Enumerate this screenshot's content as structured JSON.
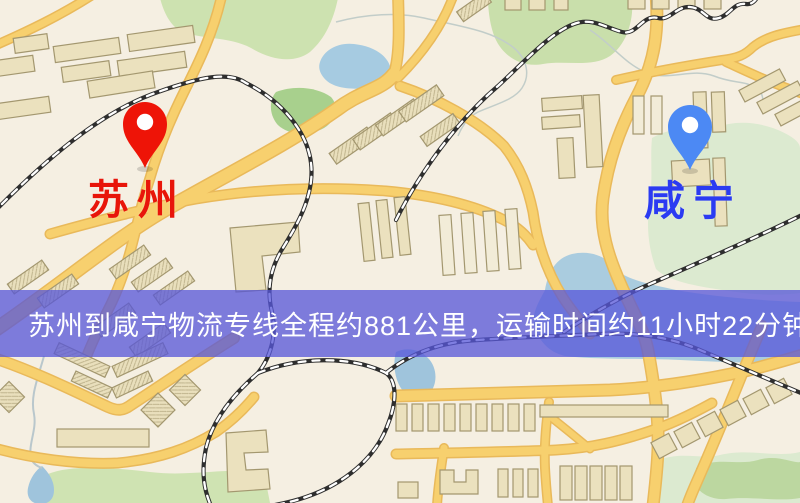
{
  "markers": {
    "origin": {
      "label": "苏州",
      "color": "#e8150a",
      "pin": "red-pin"
    },
    "destination": {
      "label": "咸宁",
      "color": "#2b3bf2",
      "pin": "blue-pin"
    }
  },
  "banner": {
    "text": "苏州到咸宁物流专线全程约881公里，运输时间约11小时22分钟.",
    "background": "#5757d9",
    "text_color": "#ffffff"
  },
  "route": {
    "origin": "苏州",
    "destination": "咸宁",
    "distance_km": "881",
    "duration": "11小时22分钟"
  },
  "palette": {
    "map_background": "#f5efe2",
    "road_fill": "#f7d06e",
    "road_casing": "#e9b95a",
    "water": "#a6cbe1",
    "park": "#cde2b0",
    "park_dark": "#a8d08d",
    "building_fill": "#ebe1be",
    "building_stroke": "#a3976f",
    "railway": "#2e2e2e",
    "pin_red": "#ee1407",
    "pin_blue": "#4c89f4"
  }
}
